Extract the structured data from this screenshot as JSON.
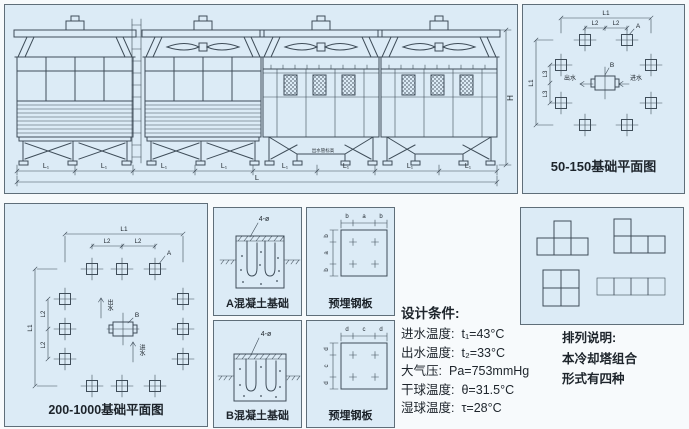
{
  "colors": {
    "page_bg": "#f7fafc",
    "panel_bg": "#dcebf6",
    "panel_border": "#5f6e79",
    "line": "#3f4d59",
    "text": "#1d242b"
  },
  "elevation": {
    "dim_l1": "L₁",
    "dim_l": "L",
    "dim_h": "H",
    "pipe_note": "出水管标高"
  },
  "plan_small": {
    "caption": "50-150基础平面图",
    "dim_l1": "L1",
    "dim_l2": "L2",
    "dim_l3": "L3",
    "label_a": "A",
    "label_b": "B",
    "label_out": "出水",
    "label_in": "进水"
  },
  "plan_large": {
    "caption": "200-1000基础平面图",
    "dim_l1": "L1",
    "dim_l2": "L2",
    "label_a": "A",
    "label_b": "B",
    "label_out": "出水",
    "label_in": "进水"
  },
  "foundation_a": {
    "dim": "4-ø",
    "caption": "A混凝土基础"
  },
  "foundation_b": {
    "dim": "4-ø",
    "caption": "B混凝土基础"
  },
  "plate_ab": {
    "caption": "预埋钢板",
    "dim_outer": "b",
    "dim_inner": "a"
  },
  "plate_cd": {
    "caption": "预埋钢板",
    "dim_outer": "d",
    "dim_inner": "c"
  },
  "design_conditions": {
    "title": "设计条件:",
    "items": [
      {
        "label": "进水温度:",
        "value": "t₁=43°C"
      },
      {
        "label": "出水温度:",
        "value": "t₂=33°C"
      },
      {
        "label": "大气压:",
        "value": "Pa=753mmHg"
      },
      {
        "label": "干球温度:",
        "value": "θ=31.5°C"
      },
      {
        "label": "湿球温度:",
        "value": "τ=28°C"
      }
    ]
  },
  "arrangement_note": {
    "title": "排列说明:",
    "line1": "本冷却塔组合",
    "line2": "形式有四种"
  }
}
